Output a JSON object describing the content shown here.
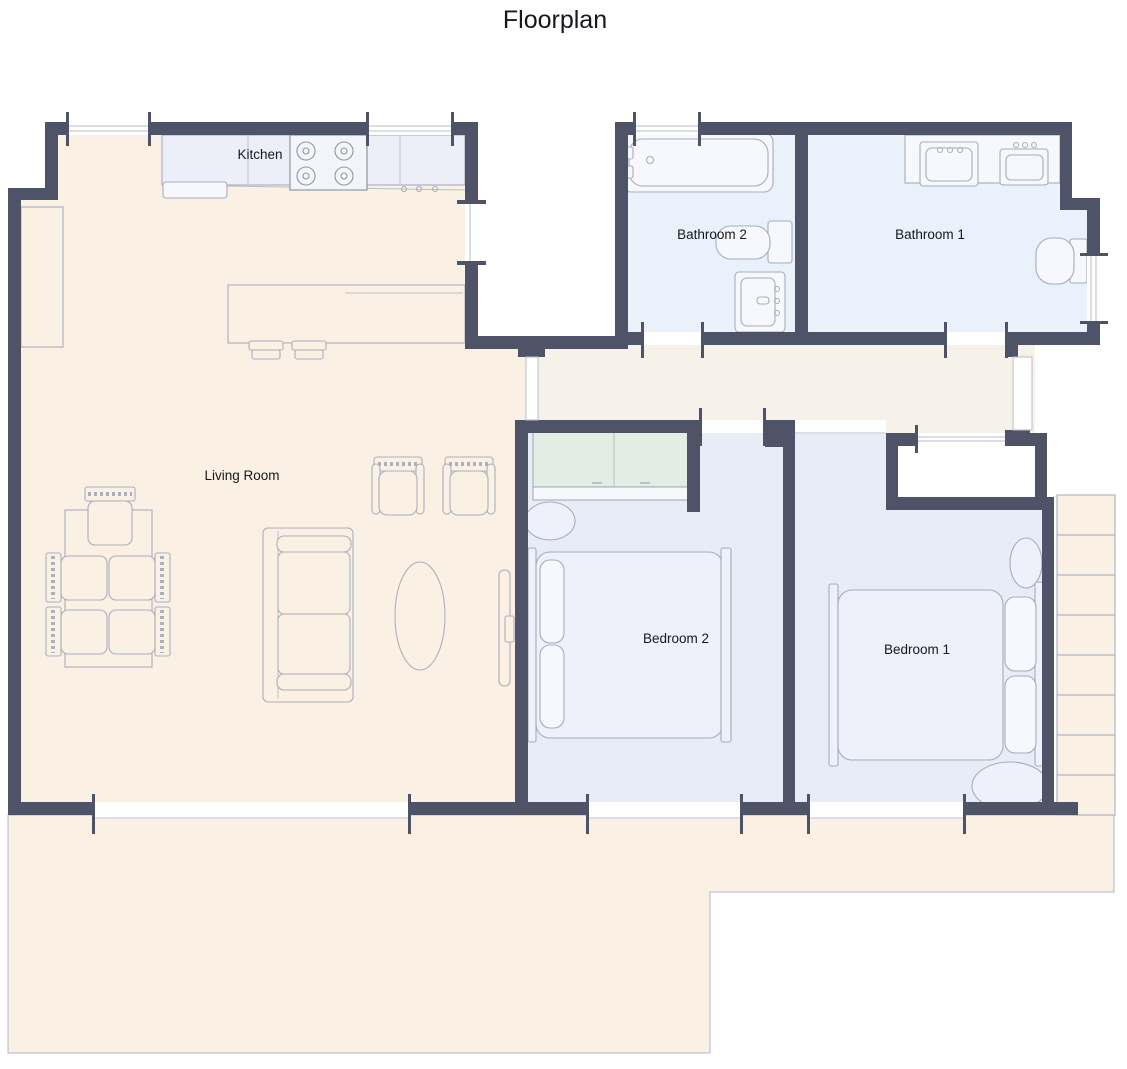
{
  "title": "Floorplan",
  "palette": {
    "wall": "#4e5368",
    "living_floor": "#faf0e4",
    "bathroom_floor": "#e9f1fa",
    "bedroom_floor": "#e8ecf6",
    "hallway_floor": "#f6f2ea",
    "closet_door": "#e2eee4",
    "kitchen_counter": "#edeff8",
    "furniture_outline": "#aab0bc",
    "label_color": "#15181c",
    "background": "#ffffff"
  },
  "rooms": {
    "kitchen": {
      "label": "Kitchen",
      "fixtures": [
        "counter",
        "stove-4-burner",
        "dishwasher",
        "island",
        "bar-stool",
        "bar-stool"
      ]
    },
    "living_room": {
      "label": "Living Room",
      "fixtures": [
        "dining-table",
        "dining-chair-x5",
        "sofa",
        "armchair-x2",
        "oval-coffee-table",
        "tv",
        "cabinet"
      ]
    },
    "bathroom_2": {
      "label": "Bathroom 2",
      "fixtures": [
        "bathtub",
        "toilet",
        "sink-vanity"
      ]
    },
    "bathroom_1": {
      "label": "Bathroom 1",
      "fixtures": [
        "double-sink-counter",
        "toilet"
      ]
    },
    "bedroom_2": {
      "label": "Bedroom 2",
      "fixtures": [
        "double-bed",
        "sliding-wardrobe",
        "ottoman"
      ]
    },
    "bedroom_1": {
      "label": "Bedroom 1",
      "fixtures": [
        "double-bed",
        "ottoman",
        "ottoman"
      ]
    },
    "outdoor": {
      "features": [
        "patio-terrace",
        "stairs-8-steps"
      ]
    }
  }
}
